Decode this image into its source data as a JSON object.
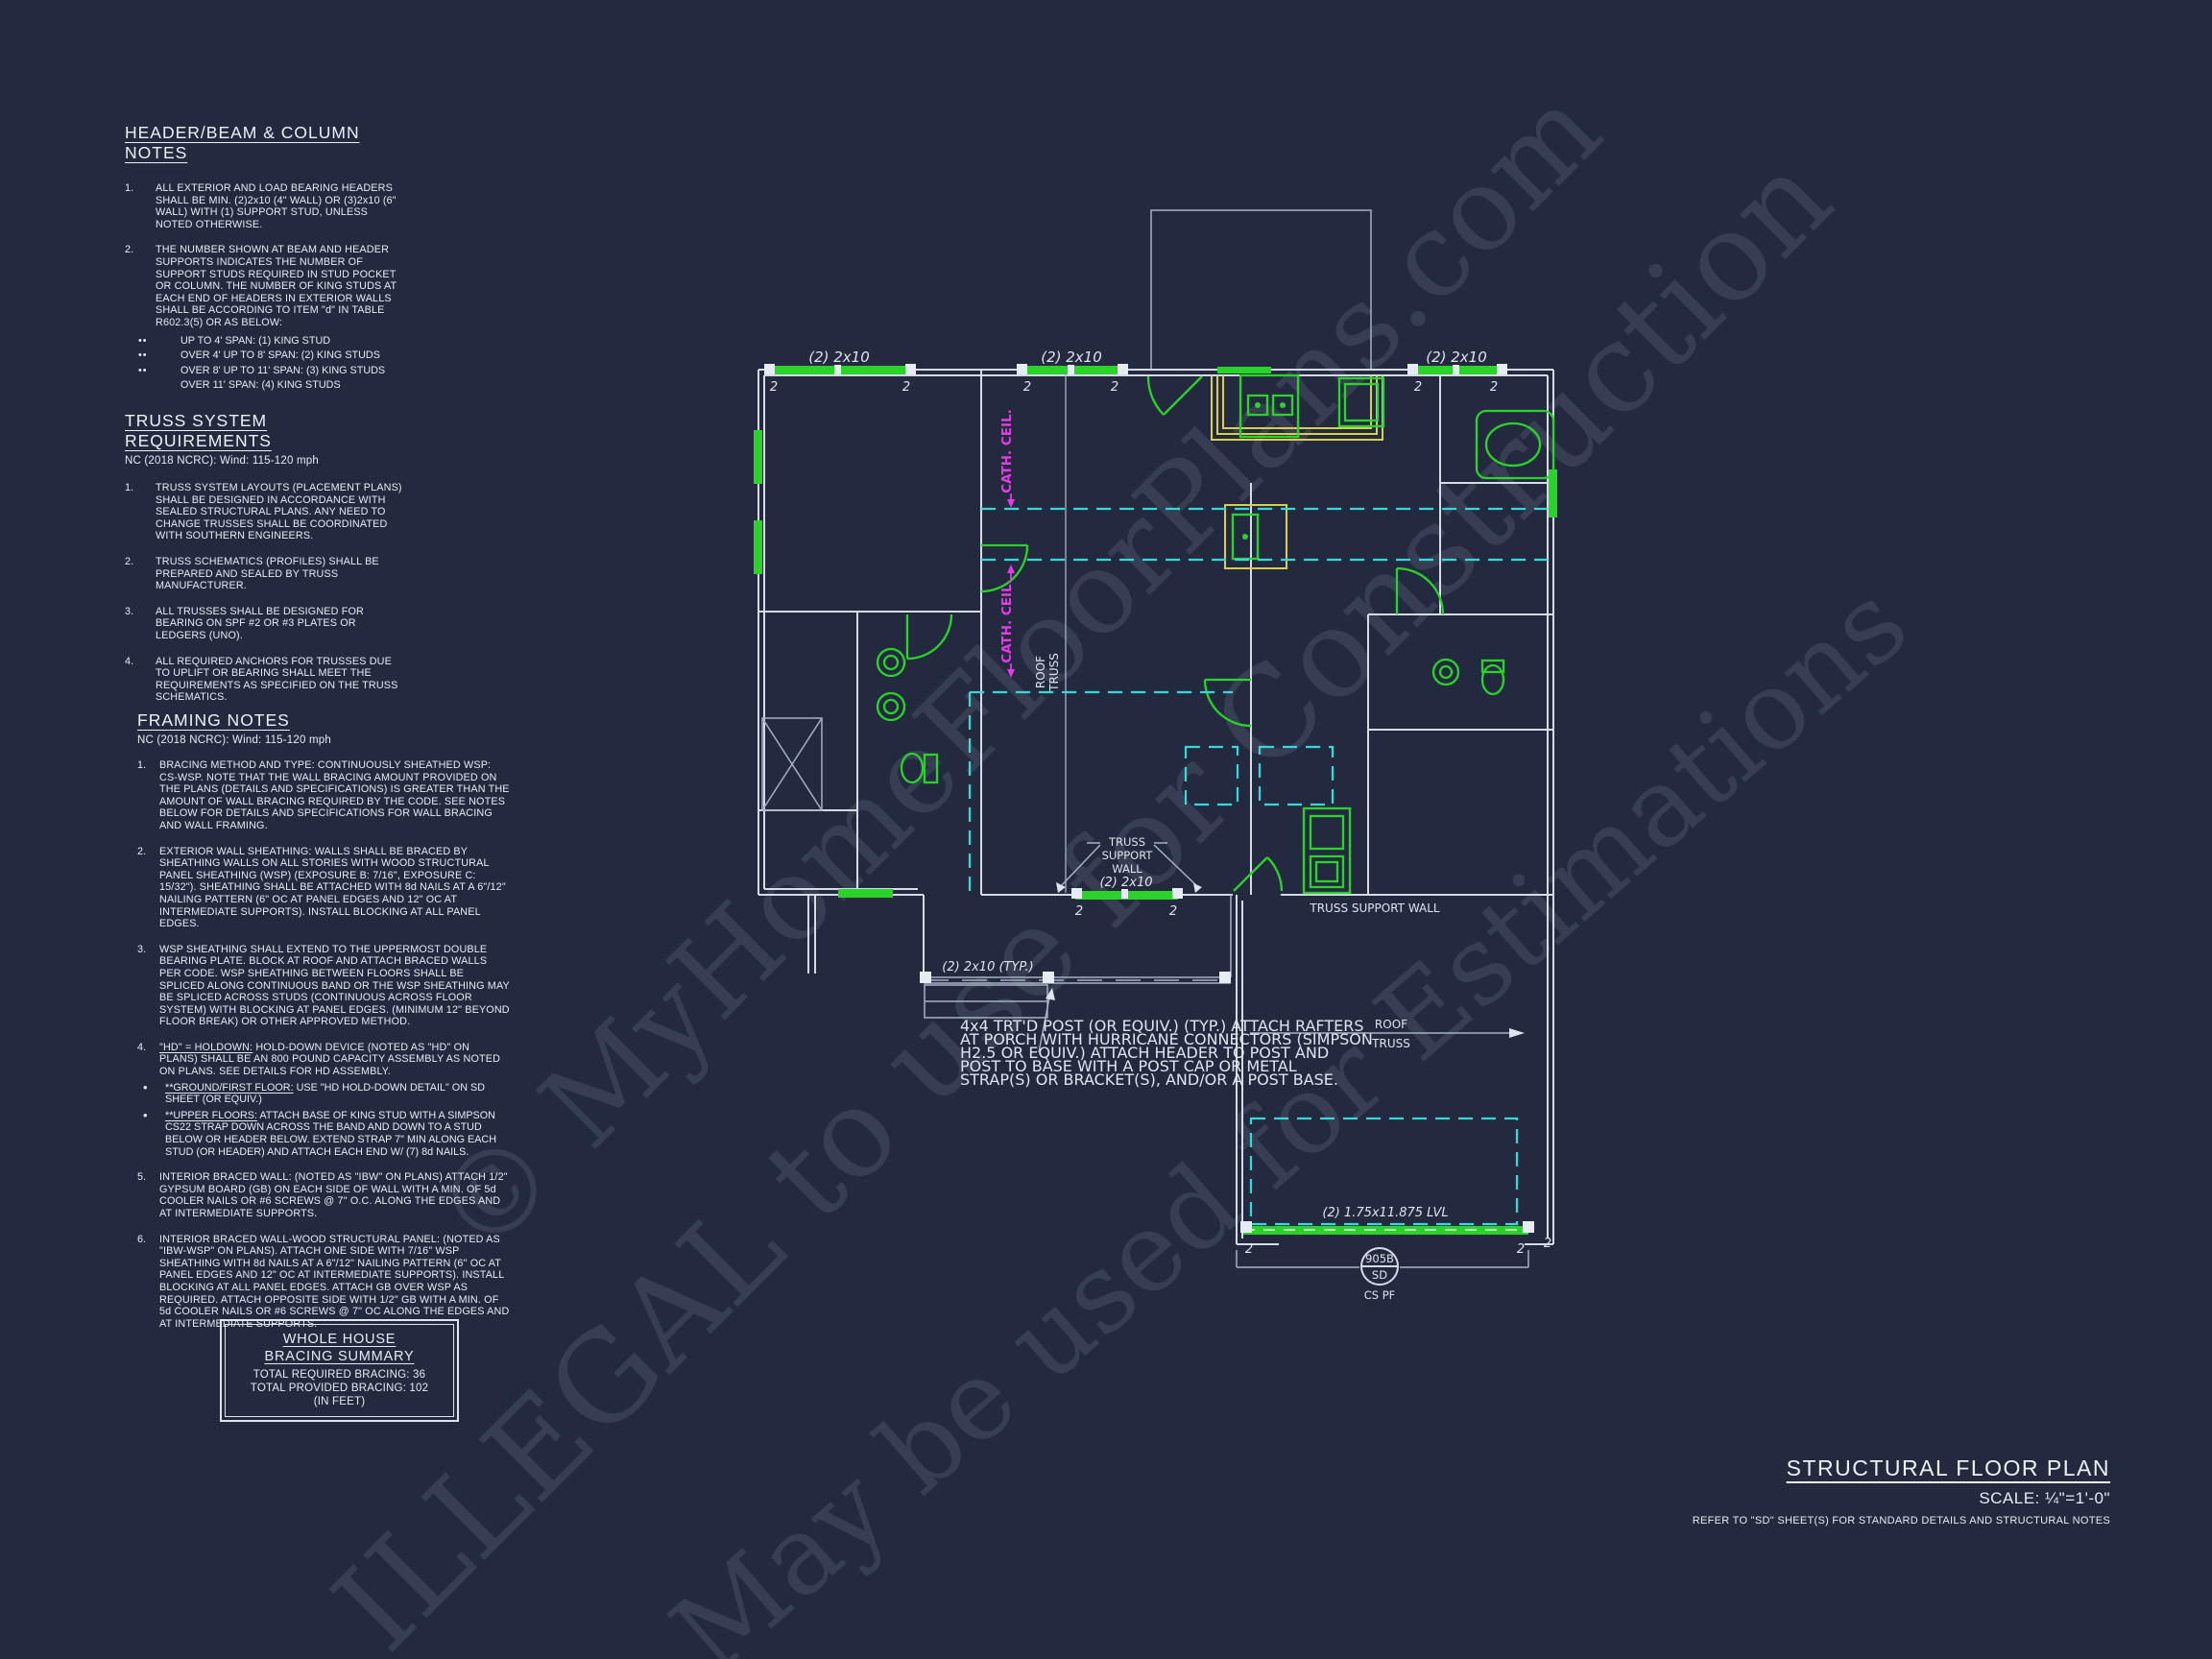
{
  "colors": {
    "background": "#232a40",
    "line": "#dfe4ef",
    "green": "#2ad22a",
    "yellow": "#d8ce4e",
    "cyan": "#38d8d8",
    "magenta": "#e23ce2"
  },
  "watermark": {
    "line1": "© MyHomeFloorPlans.com",
    "line2": "ILLEGAL to use for Construction",
    "line3": "May be used for Estimations"
  },
  "notes": {
    "header_beam": {
      "title": "HEADER/BEAM & COLUMN NOTES",
      "bullet_glyph": "••",
      "items": [
        {
          "num": "1.",
          "text": "ALL EXTERIOR AND LOAD BEARING HEADERS SHALL BE MIN. (2)2x10 (4\" WALL) OR (3)2x10 (6\" WALL) WITH (1) SUPPORT STUD, UNLESS NOTED OTHERWISE."
        },
        {
          "num": "2.",
          "text": "THE NUMBER SHOWN AT BEAM AND HEADER SUPPORTS INDICATES THE NUMBER OF SUPPORT STUDS REQUIRED IN STUD POCKET OR COLUMN. THE NUMBER OF KING STUDS AT EACH END OF HEADERS IN EXTERIOR WALLS SHALL BE ACCORDING TO ITEM \"d\" IN TABLE R602.3(5) OR AS BELOW:"
        }
      ],
      "bullets": [
        "UP TO 4' SPAN: (1) KING STUD",
        "OVER 4' UP TO 8' SPAN: (2) KING STUDS",
        "OVER 8' UP TO 11' SPAN: (3) KING STUDS",
        "OVER 11' SPAN: (4) KING STUDS"
      ]
    },
    "truss_system": {
      "title": "TRUSS SYSTEM REQUIREMENTS",
      "subtitle": "NC (2018 NCRC): Wind: 115-120 mph",
      "items": [
        {
          "num": "1.",
          "text": "TRUSS SYSTEM LAYOUTS (PLACEMENT PLANS) SHALL BE DESIGNED IN ACCORDANCE WITH SEALED STRUCTURAL PLANS. ANY NEED TO CHANGE TRUSSES SHALL BE COORDINATED WITH SOUTHERN ENGINEERS."
        },
        {
          "num": "2.",
          "text": "TRUSS SCHEMATICS (PROFILES) SHALL BE PREPARED AND SEALED BY TRUSS MANUFACTURER."
        },
        {
          "num": "3.",
          "text": "ALL TRUSSES SHALL BE DESIGNED FOR BEARING ON SPF #2 OR #3 PLATES OR LEDGERS (UNO)."
        },
        {
          "num": "4.",
          "text": "ALL REQUIRED ANCHORS FOR TRUSSES DUE TO UPLIFT OR BEARING SHALL MEET THE REQUIREMENTS AS SPECIFIED ON THE TRUSS SCHEMATICS."
        }
      ]
    },
    "framing": {
      "title": "FRAMING NOTES",
      "subtitle": "NC (2018 NCRC): Wind: 115-120 mph",
      "bullet_glyph": "•",
      "items": [
        {
          "num": "1.",
          "text": "BRACING METHOD AND TYPE: CONTINUOUSLY SHEATHED WSP: CS-WSP. NOTE THAT THE WALL BRACING AMOUNT PROVIDED ON THE PLANS (DETAILS AND SPECIFICATIONS) IS GREATER THAN THE AMOUNT OF WALL BRACING REQUIRED BY THE CODE. SEE NOTES BELOW FOR DETAILS AND SPECIFICATIONS FOR WALL BRACING AND WALL FRAMING."
        },
        {
          "num": "2.",
          "text": "EXTERIOR WALL SHEATHING: WALLS SHALL BE BRACED BY SHEATHING WALLS ON ALL STORIES WITH WOOD STRUCTURAL PANEL SHEATHING (WSP) (EXPOSURE B: 7/16\", EXPOSURE C: 15/32\"). SHEATHING SHALL BE ATTACHED WITH 8d NAILS AT A 6\"/12\" NAILING PATTERN (6\" OC AT PANEL EDGES AND 12\" OC AT INTERMEDIATE SUPPORTS). INSTALL BLOCKING AT ALL PANEL EDGES."
        },
        {
          "num": "3.",
          "text": "WSP SHEATHING SHALL EXTEND TO THE UPPERMOST DOUBLE BEARING PLATE. BLOCK AT ROOF AND ATTACH BRACED WALLS PER CODE. WSP SHEATHING BETWEEN FLOORS SHALL BE SPLICED ALONG CONTINUOUS BAND OR THE WSP SHEATHING MAY BE SPLICED ACROSS STUDS (CONTINUOUS ACROSS FLOOR SYSTEM) WITH BLOCKING AT PANEL EDGES. (MINIMUM 12\" BEYOND FLOOR BREAK) OR OTHER APPROVED METHOD."
        },
        {
          "num": "4.",
          "lead": "\"HD\" = HOLDOWN:",
          "text": " HOLD-DOWN DEVICE (NOTED AS \"HD\" ON PLANS) SHALL BE AN 800 POUND CAPACITY ASSEMBLY AS NOTED ON PLANS. SEE DETAILS FOR HD ASSEMBLY."
        },
        {
          "num": "5.",
          "text": "INTERIOR BRACED WALL: (NOTED AS \"IBW\" ON PLANS) ATTACH 1/2\" GYPSUM BOARD (GB) ON EACH SIDE OF WALL WITH A MIN. OF 5d COOLER NAILS OR #6 SCREWS @ 7\" O.C. ALONG THE EDGES AND AT INTERMEDIATE SUPPORTS."
        },
        {
          "num": "6.",
          "text": "INTERIOR BRACED WALL-WOOD STRUCTURAL PANEL: (NOTED AS \"IBW-WSP\" ON PLANS). ATTACH ONE SIDE WITH 7/16\" WSP SHEATHING WITH 8d NAILS AT A 6\"/12\" NAILING PATTERN (6\" OC AT PANEL EDGES AND 12\" OC AT INTERMEDIATE SUPPORTS). INSTALL BLOCKING AT ALL PANEL EDGES. ATTACH GB OVER WSP AS REQUIRED. ATTACH OPPOSITE SIDE WITH 1/2\" GB WITH A MIN. OF 5d COOLER NAILS OR #6 SCREWS @ 7\" OC ALONG THE EDGES AND AT INTERMEDIATE SUPPORTS."
        }
      ],
      "item4_bullets": [
        {
          "lead": "**GROUND/FIRST FLOOR:",
          "text": "  USE \"HD HOLD-DOWN DETAIL\" ON SD SHEET (OR EQUIV.)"
        },
        {
          "lead": "**UPPER FLOORS:",
          "text": " ATTACH BASE OF KING STUD WITH A SIMPSON CS22 STRAP DOWN ACROSS THE BAND AND DOWN TO A STUD BELOW OR HEADER BELOW.  EXTEND STRAP 7\" MIN ALONG EACH STUD (OR HEADER) AND ATTACH EACH END W/ (7) 8d NAILS."
        }
      ]
    },
    "bracing_summary": {
      "title1": "WHOLE HOUSE",
      "title2": "BRACING SUMMARY",
      "line1": "TOTAL REQUIRED BRACING: 36",
      "line2": "TOTAL PROVIDED BRACING: 102",
      "line3": "(IN FEET)"
    }
  },
  "plan": {
    "header_2x10": "(2) 2x10",
    "header_2x10_typ": "(2) 2x10 (TYP.)",
    "lvl": "(2) 1.75x11.875 LVL",
    "cath_ceil": "CATH. CEIL.",
    "roof": "ROOF",
    "truss": "TRUSS",
    "truss_support_wall": "TRUSS SUPPORT WALL",
    "tsw_l1": "TRUSS",
    "tsw_l2": "SUPPORT",
    "tsw_l3": "WALL",
    "stud": "2",
    "post_note_l1": "4x4 TRT'D POST (OR EQUIV.) (TYP.) ATTACH RAFTERS",
    "post_note_l2": "AT PORCH WITH HURRICANE CONNECTORS (SIMPSON",
    "post_note_l3": "H2.5 OR EQUIV.) ATTACH HEADER TO POST AND",
    "post_note_l4": "POST TO BASE WITH A POST CAP OR METAL",
    "post_note_l5": "STRAP(S) OR BRACKET(S), AND/OR A POST BASE.",
    "bubble_top": "905B",
    "bubble_bottom": "SD",
    "bubble_caption": "CS PF"
  },
  "title_block": {
    "title": "STRUCTURAL FLOOR PLAN",
    "scale": "SCALE: ¼\"=1'-0\"",
    "note": "REFER TO \"SD\" SHEET(S) FOR STANDARD DETAILS AND STRUCTURAL NOTES"
  }
}
